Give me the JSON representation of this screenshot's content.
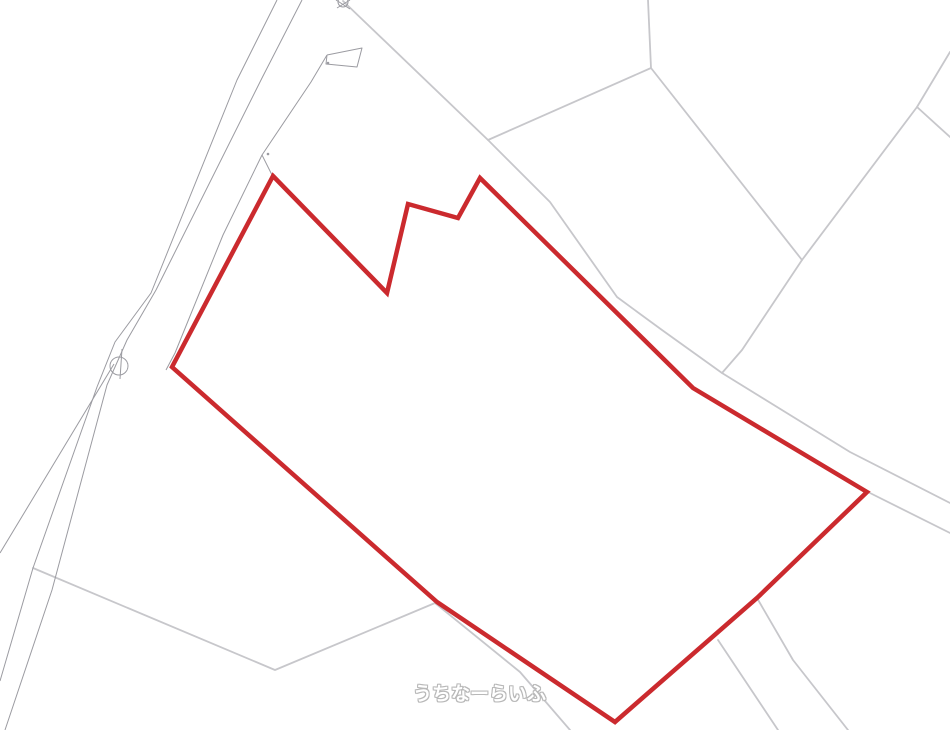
{
  "app": {
    "type": "cadastral-parcel-map-view"
  },
  "canvas": {
    "width": 950,
    "height": 730,
    "background": "#ffffff"
  },
  "colors": {
    "parcel_outline": "#cb2a2e",
    "boundary_light": "#c7c7cb",
    "boundary_dark": "#9b9ba1",
    "symbol_stroke": "#9b9ba1",
    "watermark_text": "#ffffff",
    "watermark_outline": "#b8b8b8"
  },
  "watermark": {
    "text": "うちなーらいふ",
    "x": 413,
    "y": 679,
    "font_size": 19
  },
  "parcel": {
    "label": "highlighted-land-parcel-outline",
    "stroke_width": 4.5,
    "points": [
      [
        273,
        176
      ],
      [
        387,
        293
      ],
      [
        408,
        204
      ],
      [
        458,
        218
      ],
      [
        480,
        178
      ],
      [
        693,
        388
      ],
      [
        867,
        492
      ],
      [
        757,
        598
      ],
      [
        615,
        722
      ],
      [
        437,
        602
      ],
      [
        172,
        367
      ]
    ]
  },
  "boundaries": {
    "light": [
      {
        "points": [
          [
            648,
            0
          ],
          [
            651,
            68
          ],
          [
            488,
            140
          ]
        ]
      },
      {
        "points": [
          [
            343,
            1
          ],
          [
            488,
            140
          ],
          [
            550,
            202
          ],
          [
            617,
            297
          ],
          [
            662,
            330
          ],
          [
            722,
            373
          ],
          [
            850,
            452
          ],
          [
            950,
            503
          ]
        ]
      },
      {
        "points": [
          [
            651,
            68
          ],
          [
            802,
            260
          ]
        ]
      },
      {
        "points": [
          [
            950,
            52
          ],
          [
            917,
            107
          ],
          [
            802,
            260
          ],
          [
            742,
            350
          ],
          [
            722,
            373
          ]
        ]
      },
      {
        "points": [
          [
            917,
            107
          ],
          [
            950,
            137
          ]
        ]
      },
      {
        "points": [
          [
            868,
            492
          ],
          [
            950,
            533
          ]
        ]
      },
      {
        "points": [
          [
            757,
            598
          ],
          [
            793,
            660
          ],
          [
            848,
            730
          ]
        ]
      },
      {
        "points": [
          [
            718,
            640
          ],
          [
            778,
            730
          ]
        ]
      },
      {
        "points": [
          [
            33,
            568
          ],
          [
            275,
            670
          ],
          [
            435,
            603
          ]
        ]
      },
      {
        "points": [
          [
            435,
            603
          ],
          [
            520,
            672
          ],
          [
            570,
            730
          ]
        ]
      }
    ],
    "dark": [
      {
        "points": [
          [
            277,
            0
          ],
          [
            237,
            80
          ],
          [
            151,
            293
          ],
          [
            115,
            342
          ],
          [
            97,
            387
          ],
          [
            33,
            568
          ],
          [
            0,
            681
          ]
        ]
      },
      {
        "points": [
          [
            302,
            0
          ],
          [
            262,
            78
          ],
          [
            156,
            290
          ],
          [
            127,
            340
          ],
          [
            107,
            385
          ],
          [
            52,
            590
          ],
          [
            5,
            730
          ]
        ]
      },
      {
        "points": [
          [
            327,
            55
          ],
          [
            311,
            82
          ],
          [
            262,
            155
          ],
          [
            223,
            235
          ],
          [
            175,
            353
          ],
          [
            166,
            370
          ]
        ]
      },
      {
        "points": [
          [
            262,
            155
          ],
          [
            272,
            175
          ]
        ]
      },
      {
        "points": [
          [
            114,
            364
          ],
          [
            0,
            553
          ]
        ]
      },
      {
        "points": [
          [
            122,
            349
          ],
          [
            120,
            379
          ]
        ]
      },
      {
        "points": [
          [
            327,
            55
          ],
          [
            362,
            48
          ],
          [
            357,
            67
          ],
          [
            326,
            64
          ],
          [
            327,
            55
          ]
        ]
      },
      {
        "points": [
          [
            336,
            0
          ],
          [
            350,
            9
          ]
        ]
      },
      {
        "points": [
          [
            350,
            0
          ],
          [
            337,
            8
          ]
        ]
      }
    ]
  },
  "symbols": {
    "circles": [
      {
        "cx": 119,
        "cy": 366,
        "r": 9
      },
      {
        "cx": 343,
        "cy": 2,
        "r": 5
      }
    ],
    "dots": [
      [
        268,
        154
      ],
      [
        328,
        63
      ]
    ]
  }
}
